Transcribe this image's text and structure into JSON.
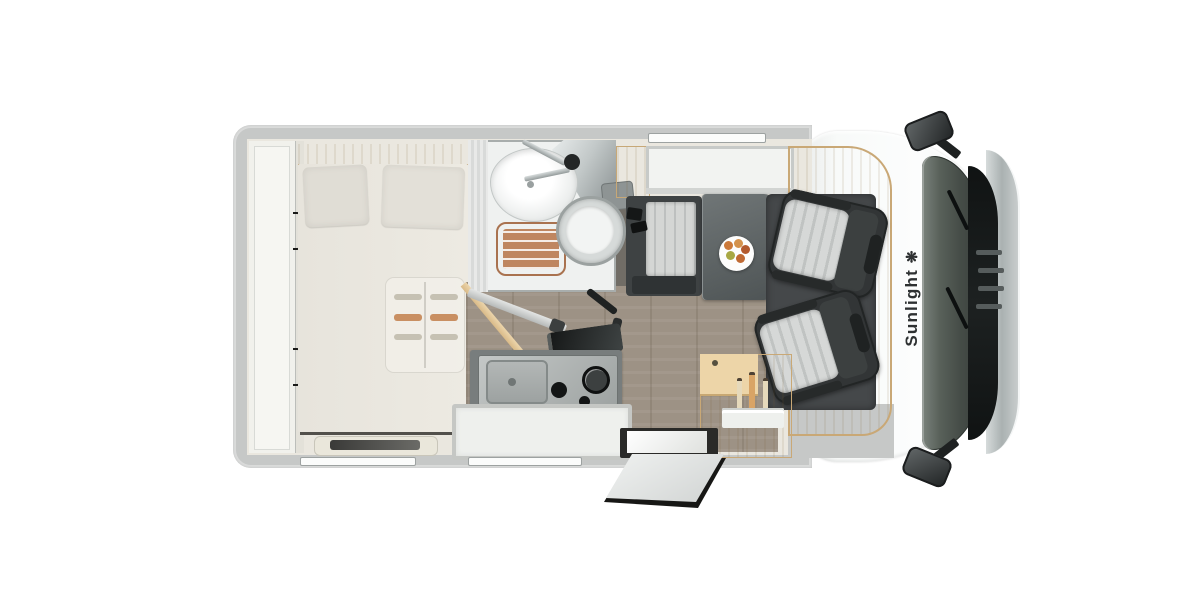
{
  "branding": {
    "name": "Sunlight",
    "logo_glyph": "❋"
  },
  "vehicle": {
    "view": "top-down floor plan of a Sunlight motorhome",
    "areas": [
      "rear-storage",
      "double-bed",
      "wardrobe",
      "bathroom",
      "washbasin",
      "shower",
      "toilet",
      "kitchen-sink",
      "kitchen-hob",
      "kitchen-drawer",
      "dinette-bench",
      "dinette-table",
      "fruit-plate",
      "swivel-seat-passenger",
      "swivel-seat-driver",
      "side-cabinet",
      "entry-door",
      "cab",
      "windscreen",
      "side-mirror-left",
      "side-mirror-right"
    ]
  },
  "colors": {
    "wall": "#c6c8c7",
    "floor": "#eae7df",
    "plank": "#9d9285",
    "wood": "#d9ba88",
    "wood-light": "#ecd5ab",
    "mattress": "#e9e6de",
    "pillow": "#e0ddd5",
    "bathroom": "#eff1f0",
    "shower-mat": "#bf8660",
    "counter": "#787d7d",
    "seat-dark": "#323536",
    "seat-stripe": "#d6d8d7",
    "cushion": "#d4d6d4",
    "table": "#5b6163",
    "cab": "#f8faf9",
    "windshield": "#454c47",
    "cowl": "#141718",
    "chrome": "#b7bdbd",
    "brand": "#2e3132"
  }
}
